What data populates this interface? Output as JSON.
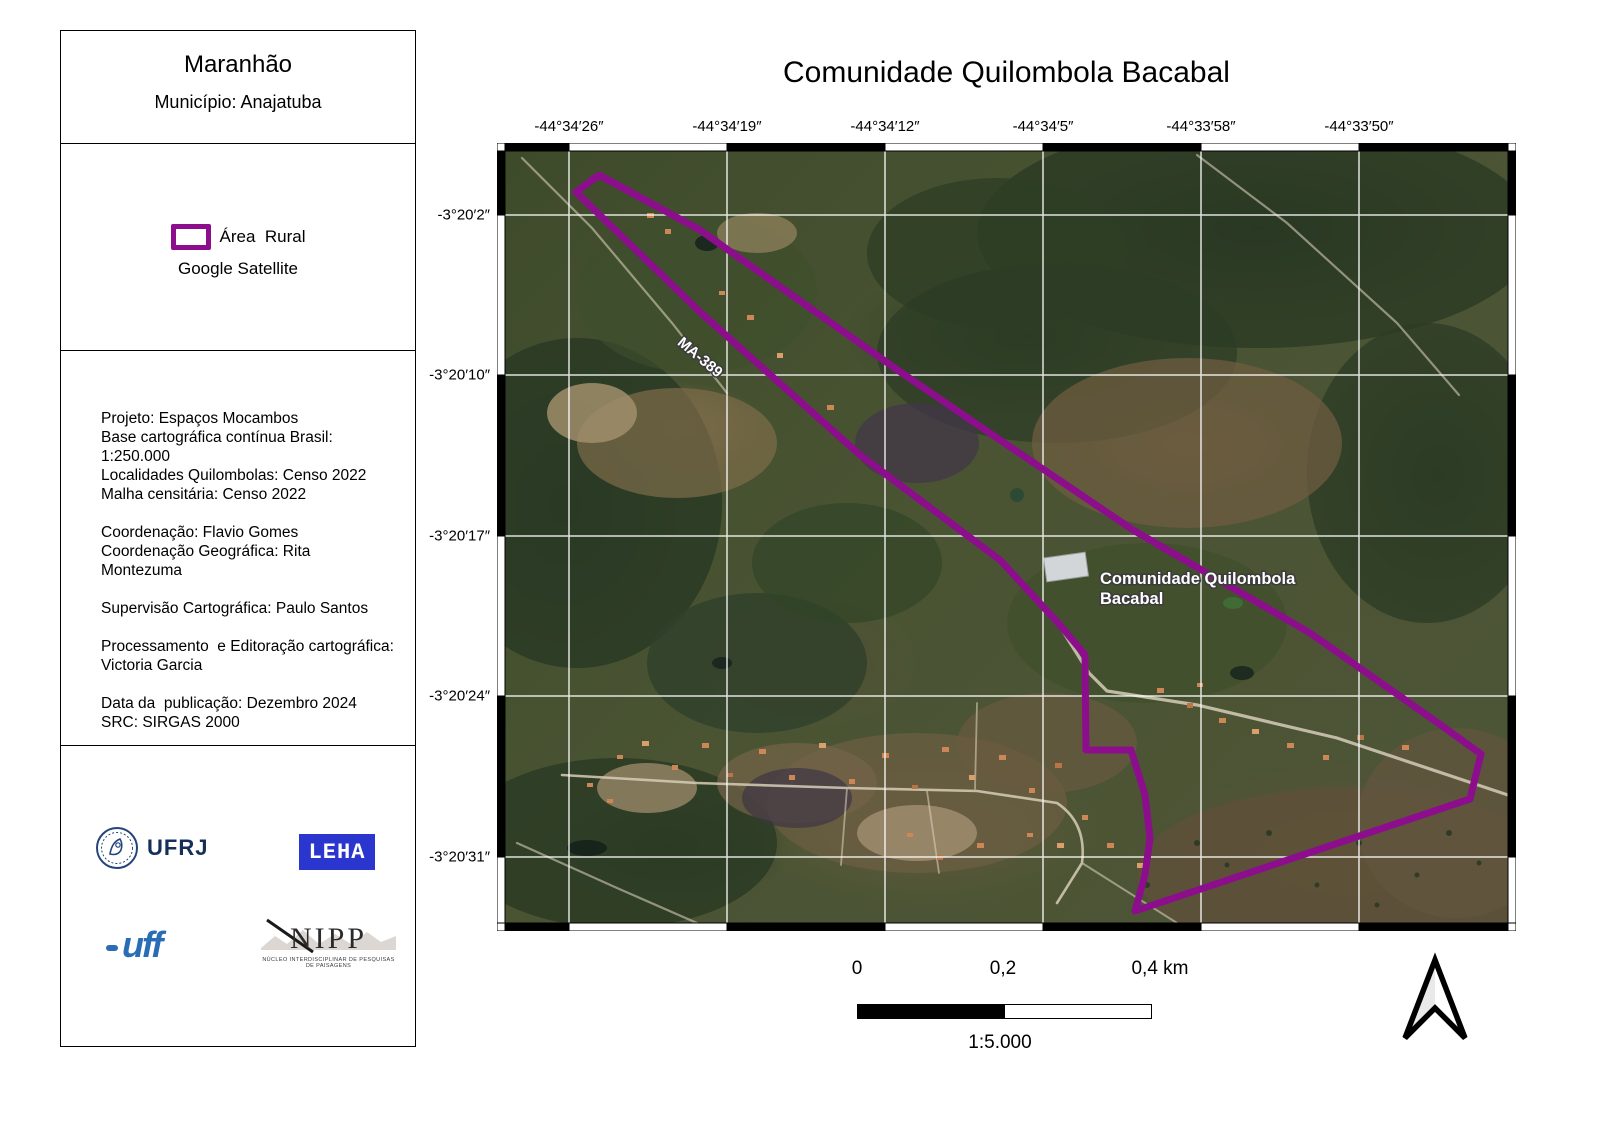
{
  "panel": {
    "state": "Maranhão",
    "municipality": "Município: Anajatuba",
    "legend": {
      "area_label": "Área  Rural",
      "basemap_label": "Google Satellite",
      "area_color": "#8c0e8c"
    },
    "credits": [
      "Projeto: Espaços Mocambos",
      "Base cartográfica contínua Brasil:",
      "1:250.000",
      "Localidades Quilombolas: Censo 2022",
      "Malha censitária: Censo 2022",
      "",
      "Coordenação: Flavio Gomes",
      "Coordenação Geográfica: Rita Montezuma",
      "",
      "Supervisão Cartográfica: Paulo Santos",
      "",
      "Processamento  e Editoração cartográfica:",
      "Victoria Garcia",
      "",
      "Data da  publicação: Dezembro 2024",
      "SRC: SIRGAS 2000"
    ],
    "logos": {
      "ufrj_text": "UFRJ",
      "leha_text": "LEHA",
      "uff_text": "uff",
      "nipp_text": "NIPP",
      "nipp_subtitle": "NÚCLEO INTERDISCIPLINAR DE PESQUISAS DE PAISAGENS"
    }
  },
  "map": {
    "title": "Comunidade Quilombola Bacabal",
    "x_labels": [
      "-44°34′26″",
      "-44°34′19″",
      "-44°34′12″",
      "-44°34′5″",
      "-44°33′58″",
      "-44°33′50″"
    ],
    "y_labels": [
      "-3°20′2″",
      "-3°20′10″",
      "-3°20′17″",
      "-3°20′24″",
      "-3°20′31″"
    ],
    "road_label": "MA-389",
    "place_label_line1": "Comunidade Quilombola",
    "place_label_line2": "Bacabal",
    "area_outline_color": "#8c0e8c",
    "area_outline_points": "102,32 203,87 402,228 503,297 636,387 813,490 941,580 984,611 973,656 638,768 648,732 653,695 648,652 634,607 589,607 588,512 563,482 503,417 363,312 203,169 79,49"
  },
  "scalebar": {
    "tick0": "0",
    "tick1": "0,2",
    "tick2": "0,4 km",
    "ratio": "1:5.000"
  }
}
